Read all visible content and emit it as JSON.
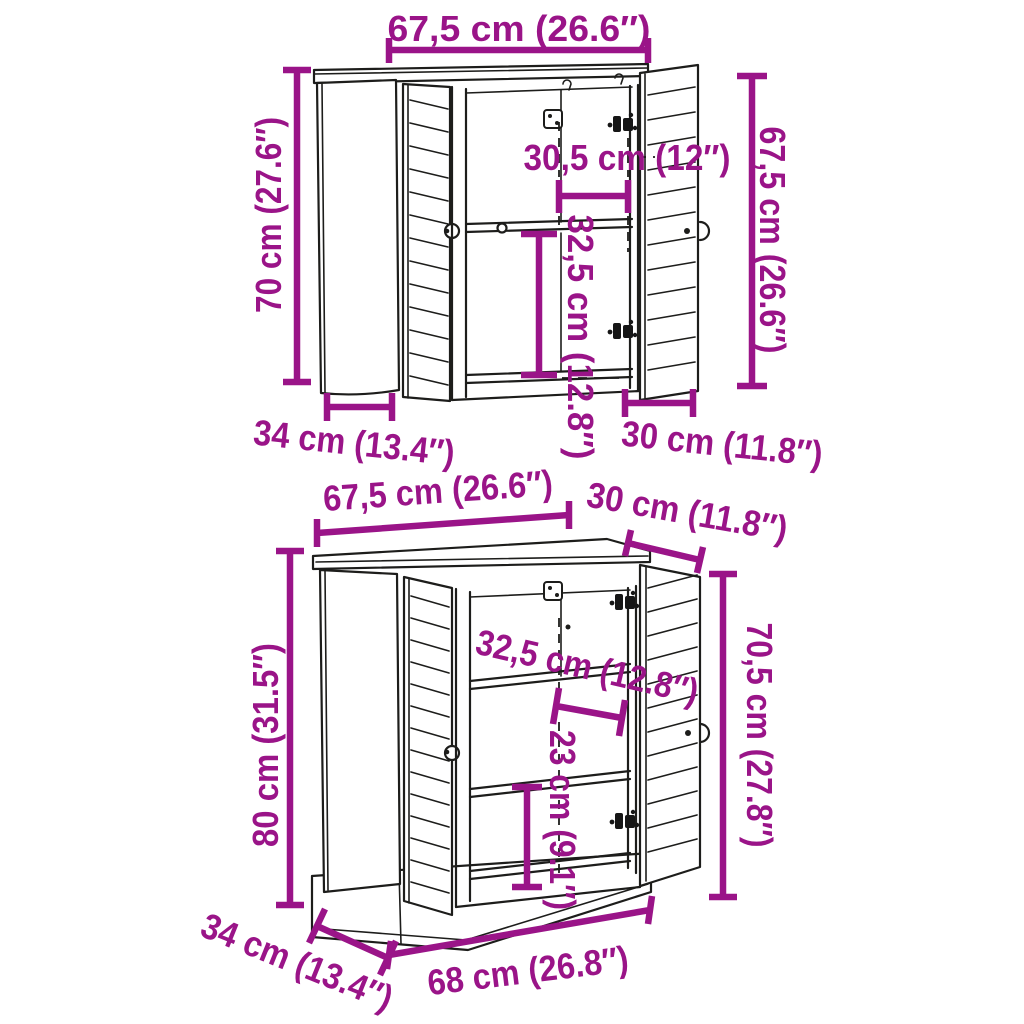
{
  "colors": {
    "accent": "#9A1488",
    "line": "#1D1D1B",
    "background": "#FFFFFF"
  },
  "upper_cabinet": {
    "dimensions": {
      "top_width": "67,5 cm (26.6″)",
      "left_height": "70 cm (27.6″)",
      "right_height": "67,5 cm (26.6″)",
      "inner_width": "30,5 cm (12″)",
      "inner_height": "32,5 cm (12.8″)",
      "depth_left": "34 cm (13.4″)",
      "depth_right": "30 cm (11.8″)"
    }
  },
  "lower_cabinet": {
    "dimensions": {
      "top_width": "67,5 cm (26.6″)",
      "top_depth_right": "30 cm (11.8″)",
      "left_height": "80 cm (31.5″)",
      "shelf_gap_upper": "32,5 cm (12.8″)",
      "shelf_gap_lower": "23 cm (9.1″)",
      "right_height": "70,5 cm (27.8″)",
      "depth_left": "34 cm (13.4″)",
      "bottom_width": "68 cm (26.8″)"
    }
  }
}
